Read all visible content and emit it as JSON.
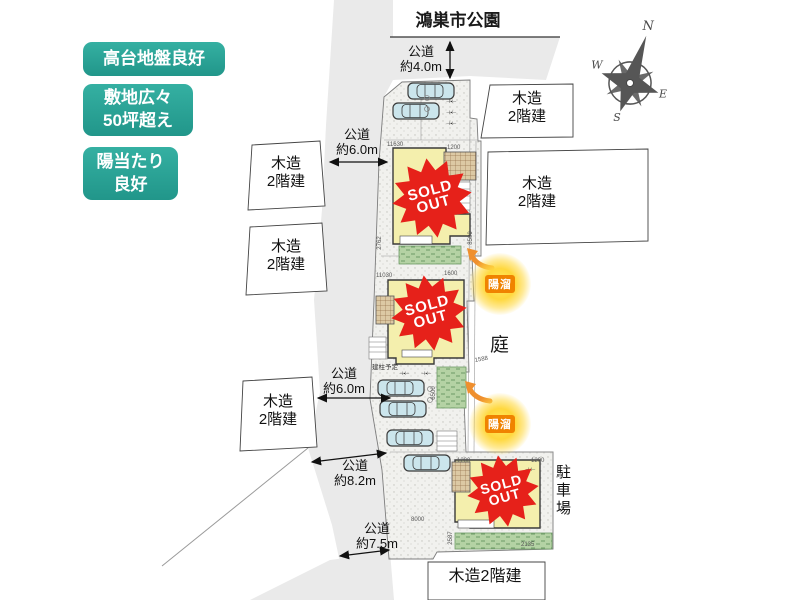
{
  "badges": {
    "b1": "高台地盤良好",
    "b2": "敷地広々\n50坪超え",
    "b3": "陽当たり\n良好"
  },
  "park": {
    "label": "鴻巣市公園"
  },
  "roads": {
    "r40": "公道\n約4.0m",
    "r60a": "公道\n約6.0m",
    "r60b": "公道\n約6.0m",
    "r82": "公道\n約8.2m",
    "r75": "公道\n約7.5m"
  },
  "neighbors": {
    "left1": "木造\n2階建",
    "left2": "木造\n2階建",
    "left3": "木造\n2階建",
    "right1": "木造\n2階建",
    "right2": "木造\n2階建",
    "bottom": "木造2階建"
  },
  "site": {
    "garden": "庭",
    "parking_lot": "駐車場",
    "pole_note": "建柱予定",
    "stall_mark": "⊣▪⊢"
  },
  "stamp": {
    "line1": "SOLD",
    "line2": "OUT"
  },
  "sun_badge": {
    "label": "陽溜"
  },
  "compass": {
    "n": "N",
    "e": "E",
    "s": "S",
    "w": "W"
  },
  "dims": {
    "d11630": "11630",
    "d1200a": "1200",
    "d2762": "2762",
    "d8500": "8500",
    "d11030": "11030",
    "d1600": "1600",
    "d6500": "6500",
    "d1588": "1588",
    "d1200b": "1200",
    "d1200c": "1200",
    "d8000": "8000",
    "d2587": "2587",
    "d2135": "2135"
  },
  "colors": {
    "badge_teal": "#2ba89a",
    "stamp_red": "#e6211a",
    "house_yellow": "#f4efad",
    "car_blue": "#cbe5ec",
    "garden_green": "#b4d2a4",
    "sun_orange": "#f08300",
    "road_gray": "#eaeaea"
  }
}
